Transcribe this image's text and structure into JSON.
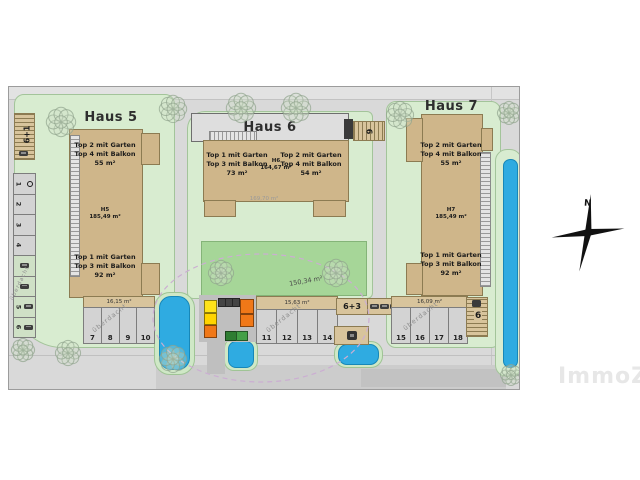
{
  "watermark": {
    "text": "ImmoZ"
  },
  "compass": {
    "label": "N"
  },
  "covered_label": "überdacht",
  "haus5": {
    "title": "Haus 5",
    "unit_top": [
      "Top 2 mit Garten",
      "Top 4 mit Balkon",
      "55 m²"
    ],
    "house_label": [
      "H5",
      "185,49 m²"
    ],
    "unit_bottom": [
      "Top 1 mit Garten",
      "Top 3 mit Balkon",
      "92 m²"
    ],
    "walkway_area": "16,15 m²",
    "parking": [
      "7",
      "8",
      "9",
      "10"
    ]
  },
  "haus6": {
    "title": "Haus 6",
    "unit_left": [
      "Top 1 mit Garten",
      "Top 3 mit Balkon",
      "73 m²"
    ],
    "house_label": [
      "H6",
      "164,67 m²"
    ],
    "unit_right": [
      "Top 2 mit Garten",
      "Top 4 mit Balkon",
      "54 m²"
    ],
    "roof_area": "169,70 m²",
    "garden_area": "150,34 m²",
    "walkway_area": "15,63 m²",
    "parking": [
      "11",
      "12",
      "13",
      "14"
    ],
    "carport_sign": "6"
  },
  "haus7": {
    "title": "Haus 7",
    "unit_top": [
      "Top 2 mit Garten",
      "Top 4 mit Balkon",
      "55 m²"
    ],
    "house_label": [
      "H7",
      "185,49 m²"
    ],
    "unit_bottom": [
      "Top 1 mit Garten",
      "Top 3 mit Balkon",
      "92 m²"
    ],
    "walkway_area": "16,09 m²",
    "parking": [
      "15",
      "16",
      "17",
      "18"
    ],
    "carport_sign": "6"
  },
  "west_parking": {
    "sign": "6+1",
    "spots": [
      "1",
      "2",
      "3",
      "4",
      "5",
      "6"
    ]
  },
  "center_sign": "6+3",
  "colors": {
    "road": "#d9d9d9",
    "lawn_light": "#d8ecd0",
    "lawn_dark": "#a6d698",
    "building_tan": "#cfb68a",
    "water_blue": "#2fabe1",
    "boundary_ellipse_pink": "#cbaed2"
  }
}
